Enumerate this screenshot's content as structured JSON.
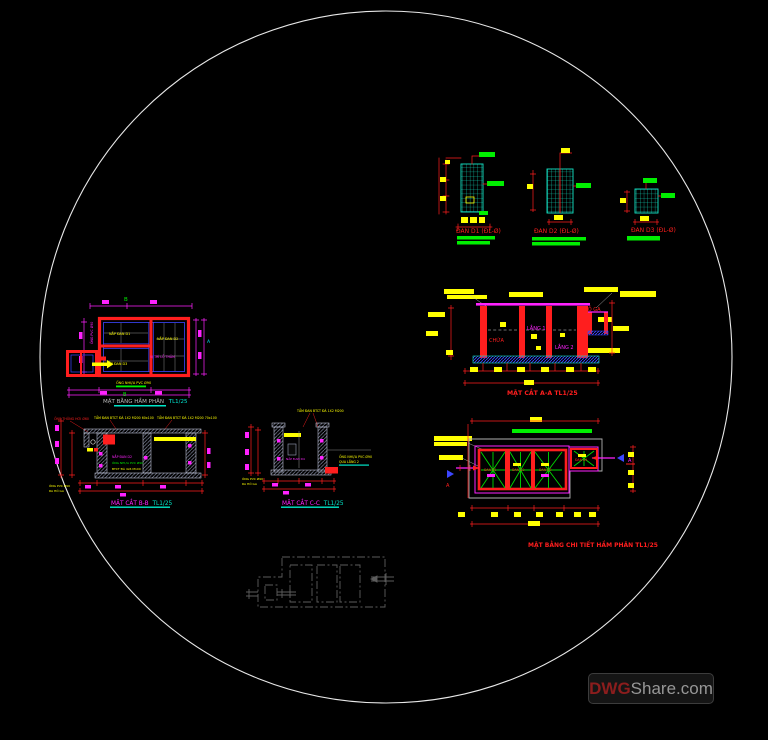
{
  "palette": {
    "red": "#ff1e1e",
    "magenta": "#ff22ff",
    "yellow": "#ffff00",
    "green": "#00ef00",
    "cyan_grid": "#14e6c8",
    "blue": "#3c46ff",
    "wall_gray": "#9aa2bd",
    "faint_gray": "#5c5c5c",
    "circle_white": "#e8e8e8"
  },
  "slab_details": {
    "d1_title": "ĐAN D1 (ĐL-Ø)",
    "d2_title": "ĐAN D2 (ĐL-Ø)",
    "d3_title": "ĐAN D3 (ĐL-Ø)"
  },
  "section_aa": {
    "title": "MẶT CẮT A-A TL1/25",
    "chamber_chua": "CHỨA",
    "chamber_lang1": "LẮNG 1",
    "chamber_lang2": "LẮNG 2",
    "chamber_hoga": "HỐ GA"
  },
  "plan_detail": {
    "title": "MẶT BẰNG CHI TIẾT HẦM PHÂN TL1/25",
    "slab1": "ĐAN D1",
    "slab2": "ĐAN D2",
    "slab3": "ĐAN D3",
    "slab4": "ĐAN D4",
    "section_marker": "A"
  },
  "plan_main": {
    "title": "MẶT BẰNG HẦM PHÂN",
    "scale": "TL1/25",
    "lid1": "NẮP ĐAN D1",
    "lid2": "NẮP ĐAN D2",
    "lid3": "NẮP ĐAN D3",
    "hole_note": "VỊ TRÍ LỖ THĂM",
    "pipe_note": "ỐNG NHỰA PVC Ø90",
    "vent_note": "ỐNG PVC Ø90",
    "axis_top": "B",
    "axis_bottom": "B",
    "section_marker": "A"
  },
  "section_bb": {
    "title": "MẶT CẮT B-B",
    "scale": "TL1/25",
    "vent_note": "ỐNG THÔNG HƠI Ø60",
    "slab_note_1": "TẤM ĐAN BTCT ĐÁ 1X2 M200 60x100",
    "slab_note_2": "TẤM ĐAN BTCT ĐÁ 1X2 M200 70x100",
    "lid_label": "NẮP ĐAN D2",
    "pipe_label": "ỐNG NHỰA PVC Ø90",
    "base_note": "BTCT ĐÁ 4x6 M100",
    "outlet_note_1": "ỐNG PVC Ø90",
    "outlet_note_2": "RA HỐ GA"
  },
  "section_cc": {
    "title": "MẶT CẮT C-C",
    "scale": "TL1/25",
    "slab_note": "TẤM ĐAN BTCT ĐÁ 1X2 M200",
    "lid_label": "NẮP ĐAN D4",
    "note_right_1": "ỐNG NHỰA PVC Ø90",
    "note_right_2": "QUA LẮNG 2",
    "note_left_1": "ỐNG PVC Ø90",
    "note_left_2": "RA HỐ GA"
  },
  "watermark": {
    "prefix": "DWG",
    "suffix": "Share.com"
  }
}
